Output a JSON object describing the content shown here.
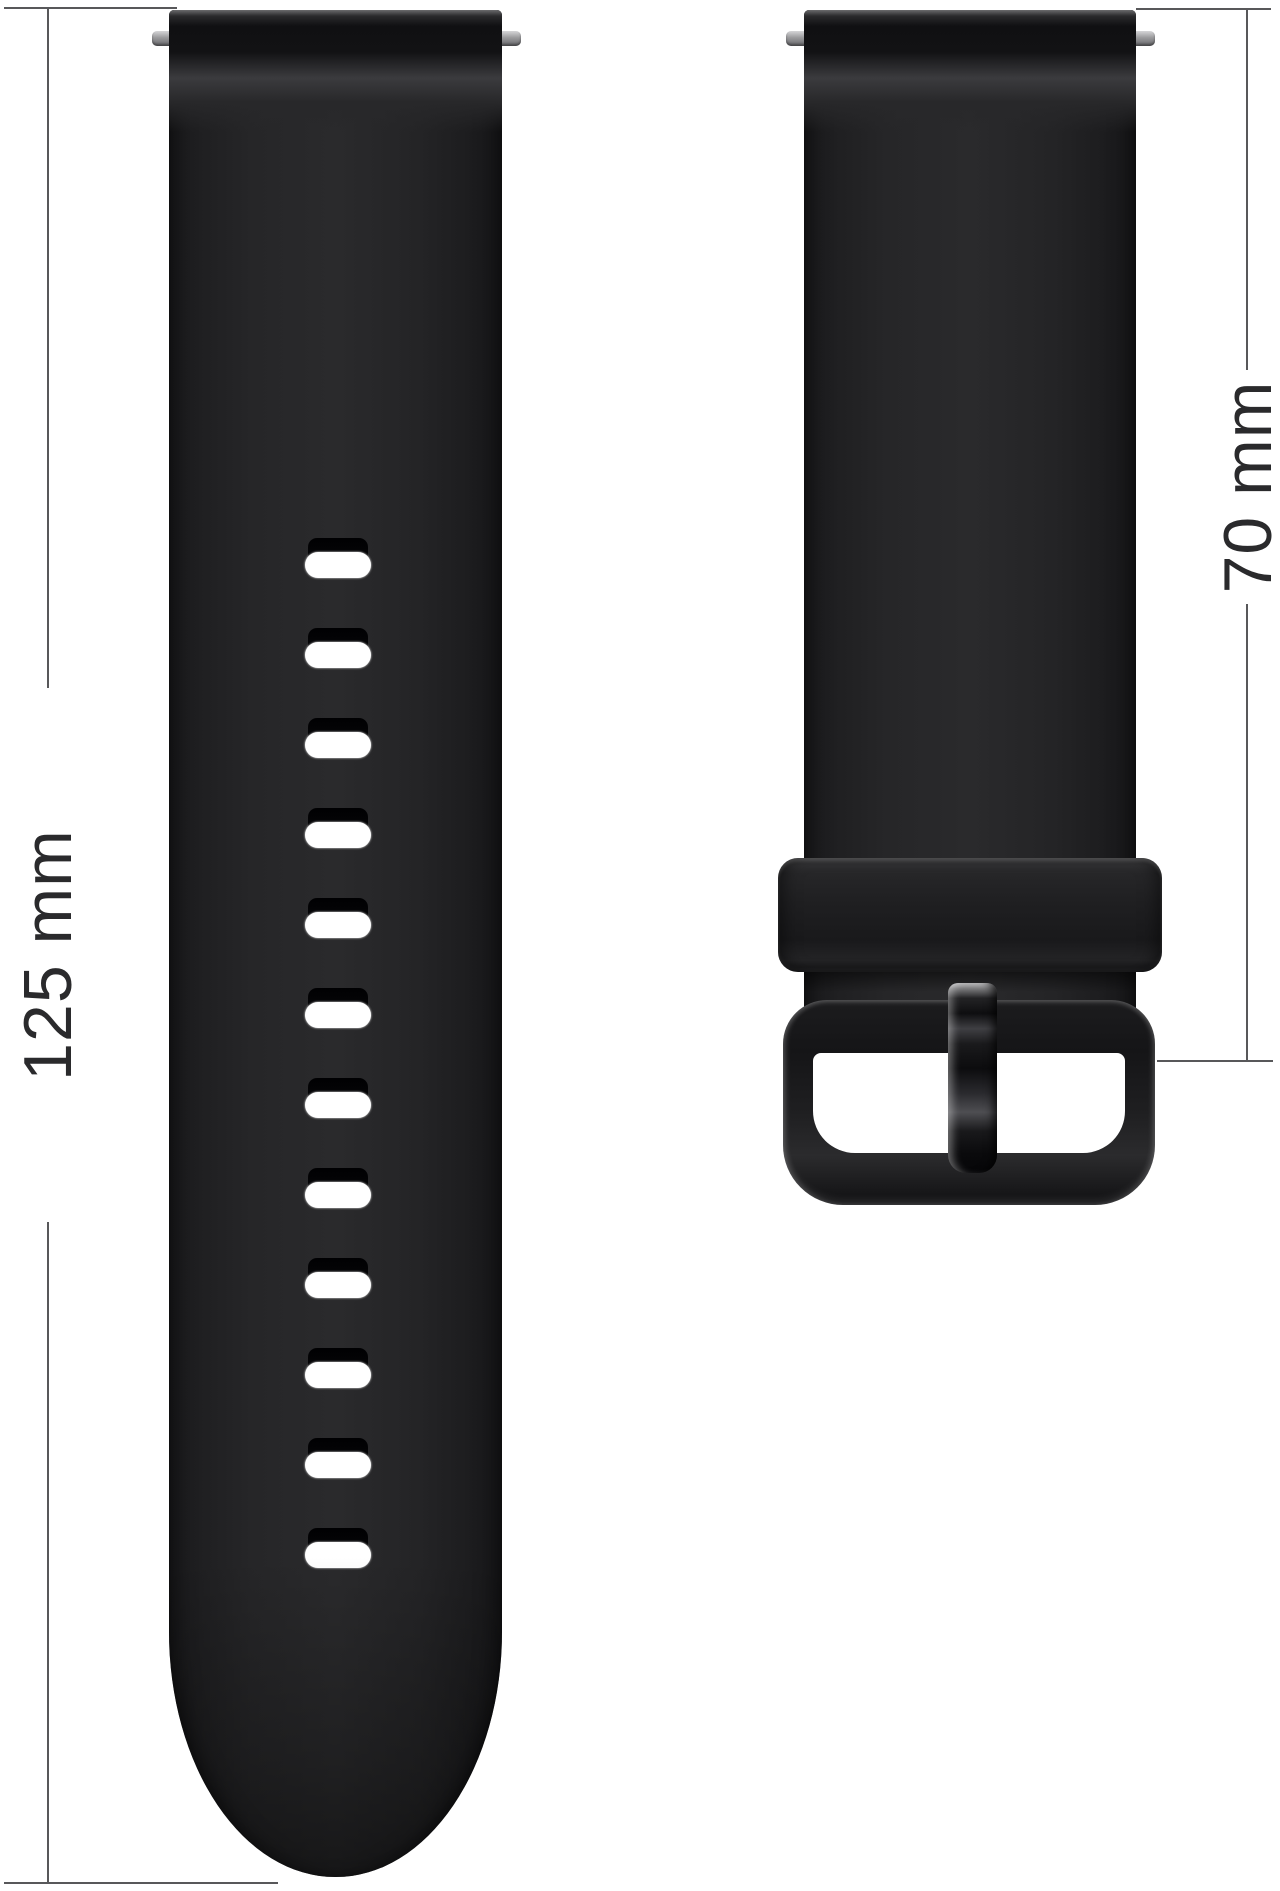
{
  "image_description": "Black silicone watch band product photo: long perforated strap half and short buckle strap half with length dimensions",
  "labels": {
    "long_strap_length": "125 mm",
    "short_strap_length": "70 mm"
  },
  "left_strap": {
    "hole_count": 12
  },
  "hardware": {
    "spring_bar_pin_count": 4,
    "keeper_loop": true,
    "buckle_frame": true,
    "buckle_tongue": true
  },
  "colors": {
    "background": "#ffffff",
    "strap": "#242426",
    "dimension_lines": "#58585a",
    "label_text": "#2a2a2c",
    "spring_bar": "#9a9a9c",
    "hole_slot": "#ffffff"
  }
}
